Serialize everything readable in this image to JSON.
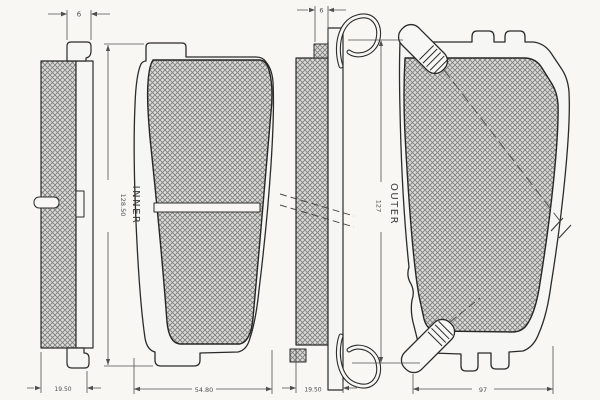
{
  "colors": {
    "background": "#f8f7f4",
    "line": "#2b2b2b",
    "dim_text": "#4f4f4f",
    "label_text": "#3a3a3a",
    "hatch_light": "#dbdbd8",
    "hatch_dark": "#7f7f7d"
  },
  "views": {
    "inner_side": {
      "pad_width_dim": "6",
      "thickness_dim": "19.50"
    },
    "inner_front": {
      "label": "INNER",
      "height_dim": "128.50",
      "width_dim": "54.80"
    },
    "outer_side": {
      "pad_width_dim": "6",
      "thickness_dim": "19.50"
    },
    "outer_front": {
      "label": "OUTER",
      "height_dim": "127",
      "width_dim": "97"
    }
  }
}
